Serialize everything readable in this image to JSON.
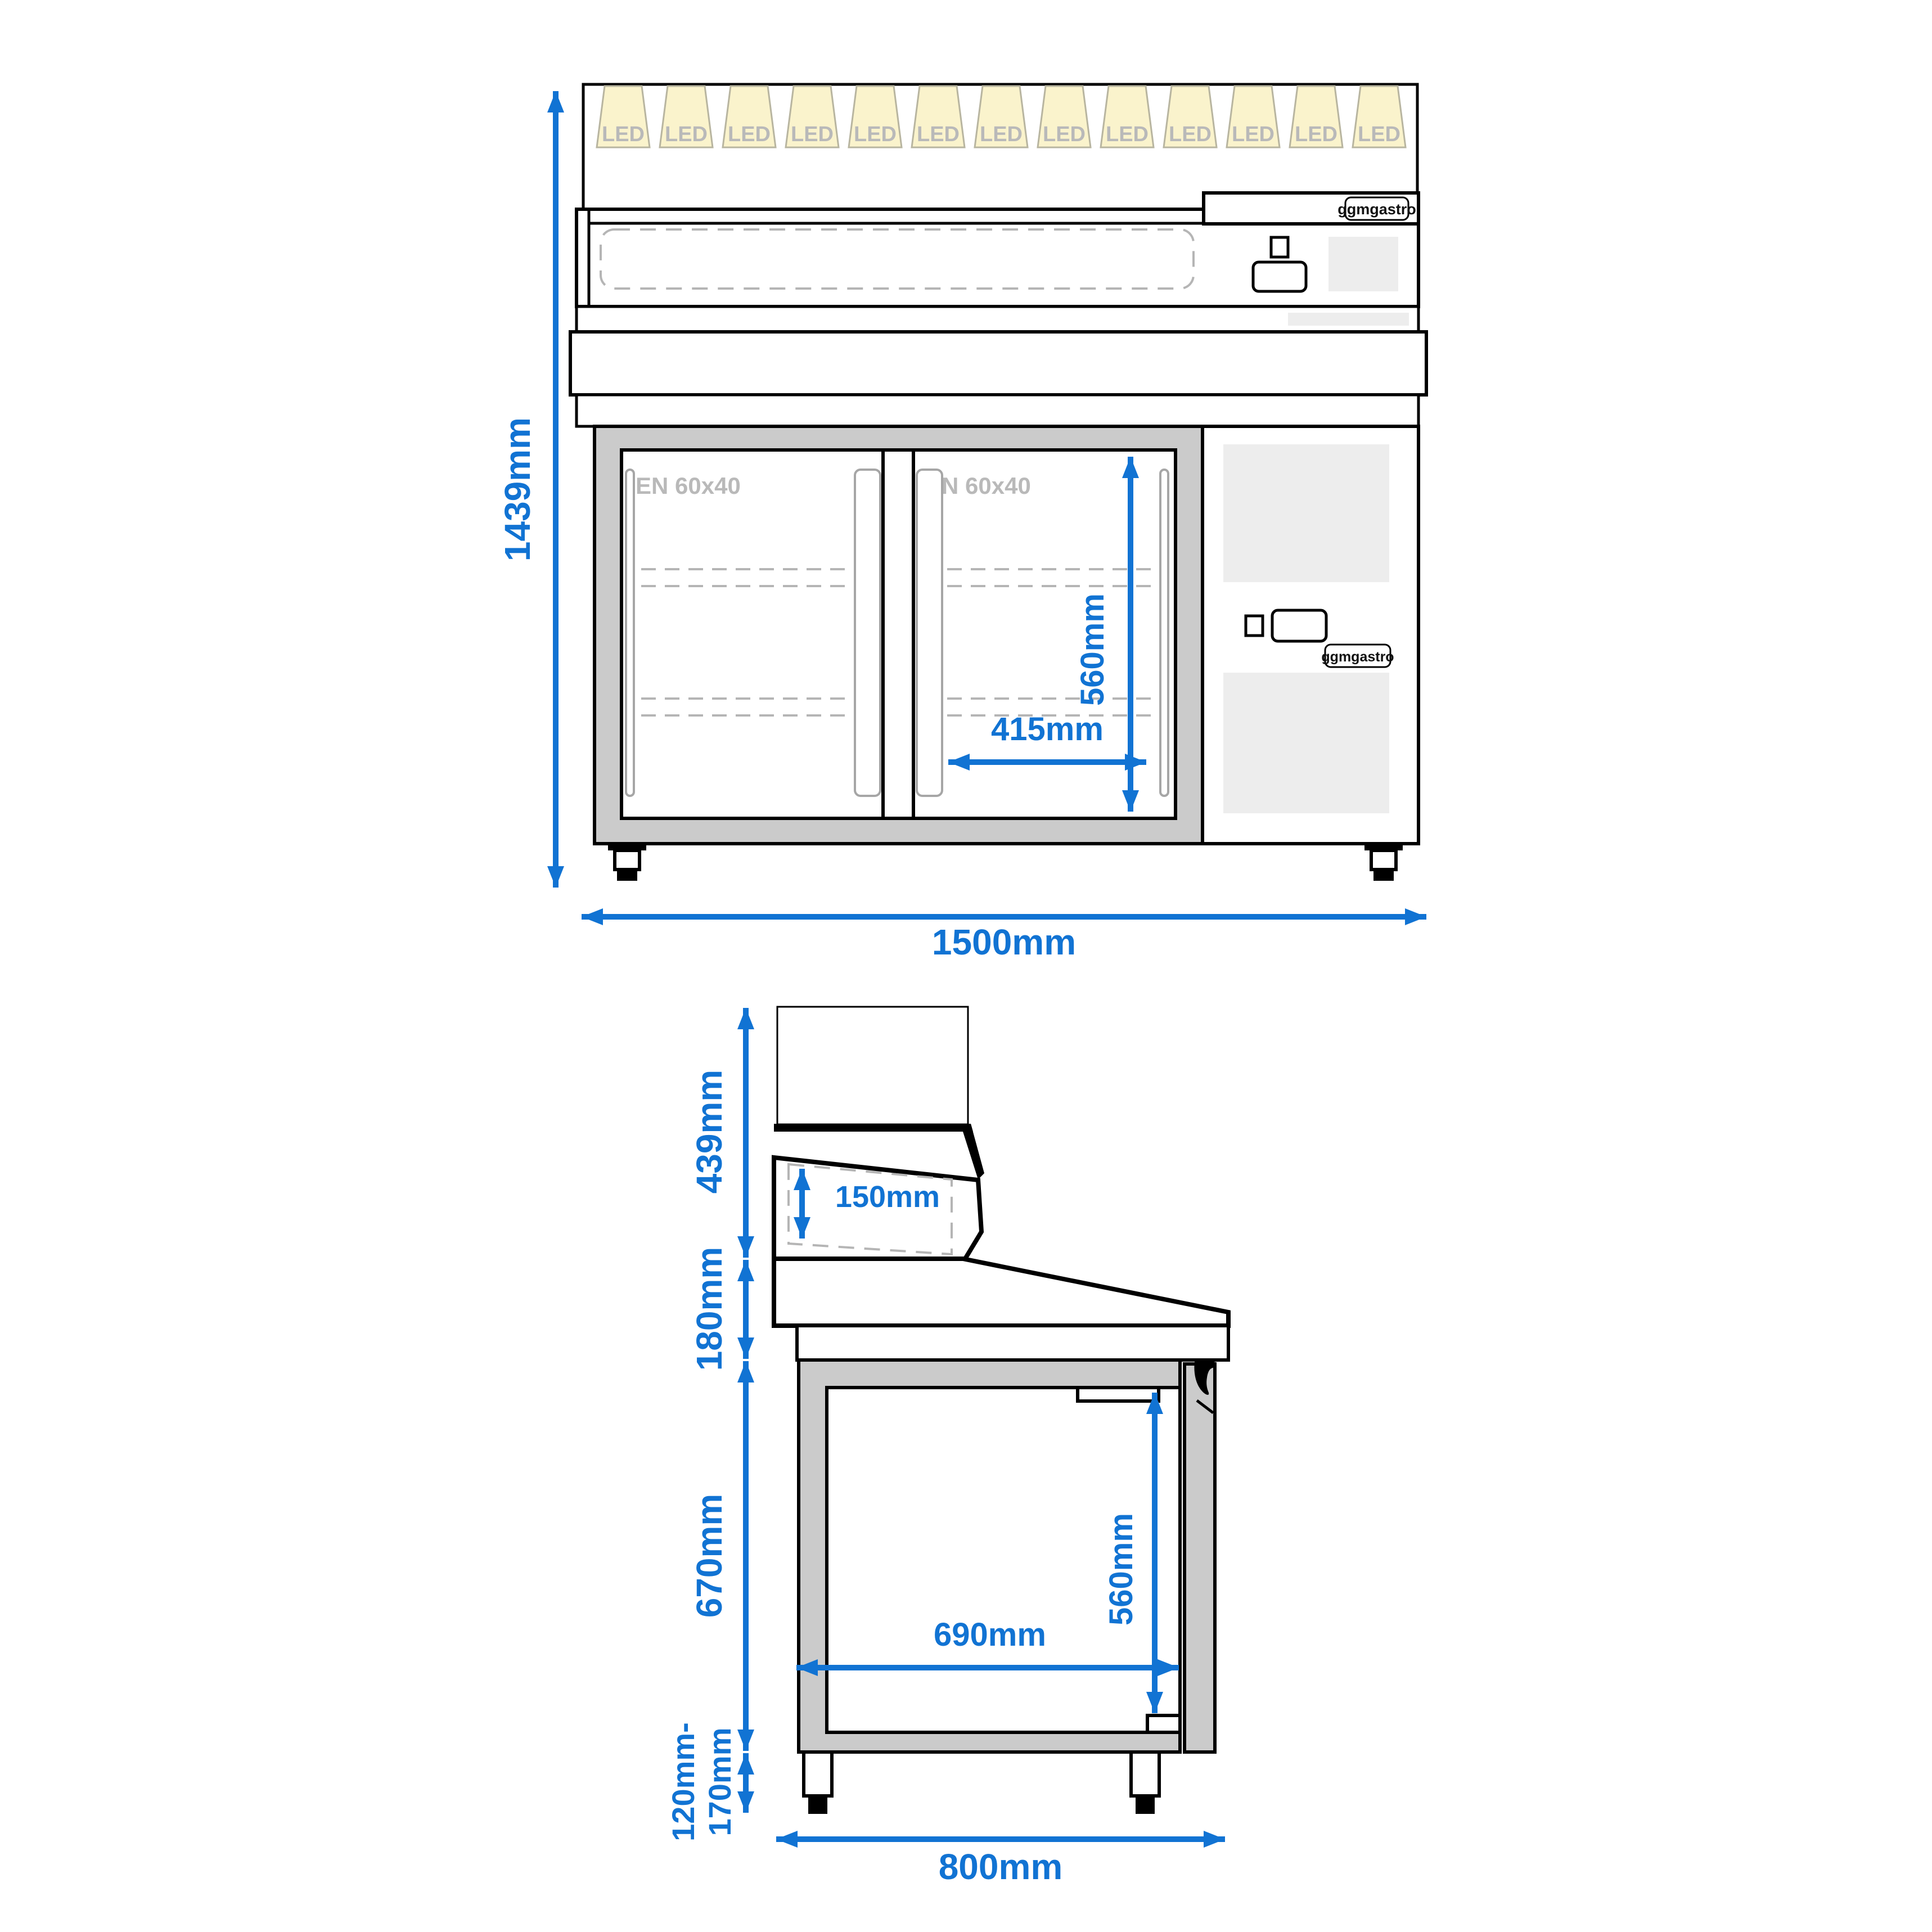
{
  "colors": {
    "dimension_blue": "#1173d3",
    "drawing_black": "#000000",
    "cabinet_gray": "#cbcbcb",
    "panel_light_gray": "#ededed",
    "led_beam_fill": "#faf3cc",
    "led_beam_stroke": "#b8b5a0"
  },
  "front_view": {
    "led_label": "LED",
    "led_count": 13,
    "tray_standard_left": "EN 60x40",
    "tray_standard_right": "EN 60x40",
    "brand_badge_top": "ggmgastro",
    "brand_badge_side": "ggmgastro",
    "dim_total_height": "1439mm",
    "dim_total_width": "1500mm",
    "dim_inner_height": "560mm",
    "dim_inner_width": "415mm"
  },
  "side_view": {
    "dim_top_section_height": "439mm",
    "dim_worktop_height": "180mm",
    "dim_cabinet_height": "670mm",
    "dim_feet_height_line1": "120mm-",
    "dim_feet_height_line2": "170mm",
    "dim_border_depth": "150mm",
    "dim_inner_height": "560mm",
    "dim_inner_depth": "690mm",
    "dim_total_depth": "800mm"
  }
}
